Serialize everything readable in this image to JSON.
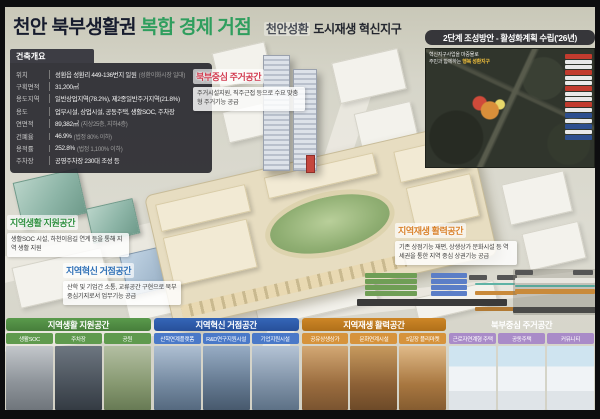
{
  "header": {
    "title_main": "천안 북부생활권",
    "title_accent": "복합 경제 거점",
    "title_sub_highlight": "천안성환",
    "title_sub": "도시재생 혁신지구",
    "accent_color": "#2f9e5e"
  },
  "overview": {
    "tab": "건축개요",
    "rows": [
      {
        "label": "위치",
        "value": "성환읍 성환리 449-136번지 일원",
        "note": "(성환이화시장 일대)"
      },
      {
        "label": "구획면적",
        "value": "31,200㎡",
        "note": ""
      },
      {
        "label": "용도지역",
        "value": "일반상업지역(78.2%), 제2종일반주거지역(21.8%)",
        "note": ""
      },
      {
        "label": "용도",
        "value": "업무시설, 상업시설, 공동주택, 생활SOC, 주차장",
        "note": ""
      },
      {
        "label": "연면적",
        "value": "89,382㎡",
        "note": "(지상25층, 지하4층)"
      },
      {
        "label": "건폐율",
        "value": "46.9%",
        "note": "(법정 80% 이하)"
      },
      {
        "label": "용적률",
        "value": "252.8%",
        "note": "(법정 1,100% 이하)"
      },
      {
        "label": "주차장",
        "value": "공영주차장 230대 조성 등",
        "note": ""
      }
    ]
  },
  "phase2": {
    "title": "2단계 조성방안 - 활성화계획 수립('26년)",
    "caption_line1": "혁신지구사업을 마중물로",
    "caption_line2": "주민과 함께하는",
    "caption_highlight": "행복 성환지구",
    "legend_colors": {
      "red": "#c23b2e",
      "blue": "#2e4f8f"
    }
  },
  "callouts": {
    "housing": {
      "title": "북부중심 주거공간",
      "color": "#d13a4e",
      "body": "주거시설지원, 직주근접 등으로 수요 맞춤형 주거기능 공급"
    },
    "life": {
      "title": "지역생활 지원공간",
      "color": "#2f8f3f",
      "body": "생활SOC 시설, 하천이음길 연계 등을 통해 지역 생활 지원"
    },
    "innovation": {
      "title": "지역혁신 거점공간",
      "color": "#2d6fb5",
      "body": "산학 및 기업간 소통, 교류공간 구현으로 북부중심기지로서 업무기능 공급"
    },
    "revital": {
      "title": "지역재생 활력공간",
      "color": "#d9822b",
      "body": "기존 상점기능 재편, 상생상가 문화시설 등 역세권을 통한 지역 중심 상권기능 공급"
    }
  },
  "bottom": {
    "sections": [
      {
        "title": "지역생활 지원공간",
        "accent": "#4f8f3f",
        "items": [
          "생활SOC",
          "주차장",
          "공원"
        ]
      },
      {
        "title": "지역혁신 거점공간",
        "accent": "#2d5fae",
        "items": [
          "산학연계플랫폼",
          "R&D연구지원시설",
          "기업지원시설"
        ]
      },
      {
        "title": "지역재생 활력공간",
        "accent": "#c9821d",
        "items": [
          "공유상생상가",
          "문화연계시설",
          "5일장 플리마켓"
        ]
      },
      {
        "title": "북부중심 주거공간",
        "accent": "#8f6cb0",
        "items": [
          "근로자연계형 주택",
          "공동주택",
          "커뮤니티"
        ]
      }
    ]
  }
}
